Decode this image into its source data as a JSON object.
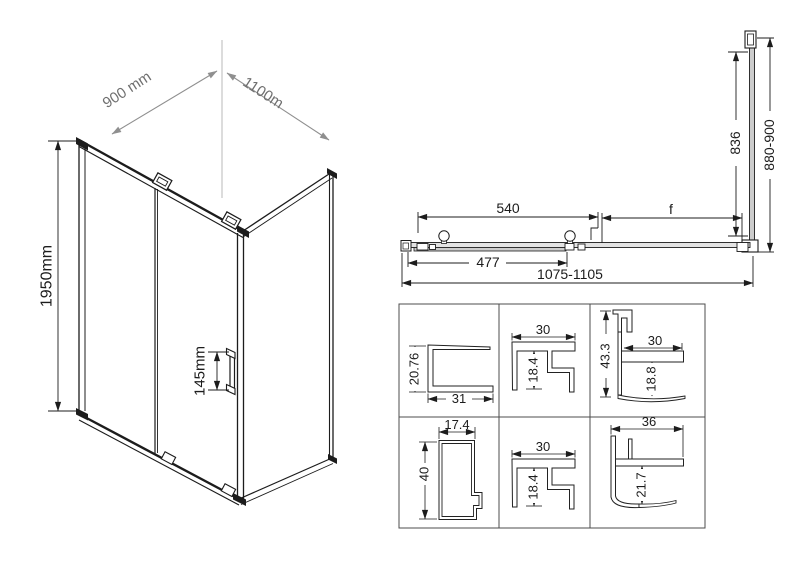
{
  "colors": {
    "line": "#1c1c1c",
    "construction_gray": "#8f8f8f",
    "glass_fill": "#cccccc",
    "track_fill": "#e3e3e3",
    "grid_border": "#4c4c4c",
    "background": "#ffffff"
  },
  "iso_view": {
    "width_dim": "900 mm",
    "depth_dim": "1100m",
    "height_dim": "1950mm",
    "handle_dim": "145mm"
  },
  "plan_view": {
    "door_span_dim": "540",
    "side_gap_dim": "f",
    "glass_width_dim": "477",
    "total_width_dim": "1075-1105",
    "side_panel_inner_dim": "836",
    "side_panel_range_dim": "880-900"
  },
  "profile_sections": {
    "r1c1": {
      "height": "20.76",
      "width": "31"
    },
    "r1c2": {
      "width": "30",
      "height": "18.4"
    },
    "r1c3": {
      "height": "43.3",
      "width": "30",
      "inner_height": "18.8"
    },
    "r2c1": {
      "width": "17.4",
      "height": "40"
    },
    "r2c2": {
      "width": "30",
      "height": "18.4"
    },
    "r2c3": {
      "width": "36",
      "height": "21.7"
    }
  }
}
